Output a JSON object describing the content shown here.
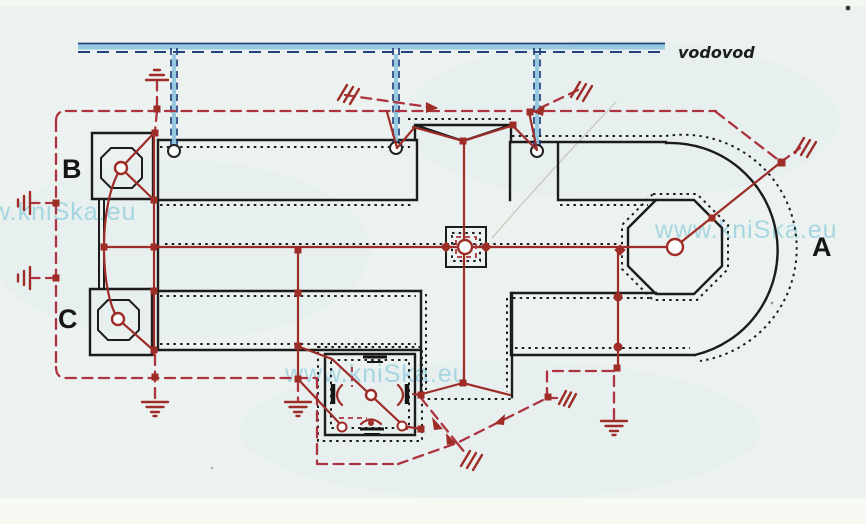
{
  "figure": {
    "description": "Scanned plan of a church building with lightning-protection earthing system, water main and grounding loop"
  },
  "labels": {
    "tower_b": "B",
    "tower_c": "C",
    "apse_a": "A",
    "water_main": "vodovod"
  },
  "watermarks": {
    "left": "w.kniSka.eu",
    "center": "www.kniSka.eu",
    "right": "www.kniSka.eu"
  },
  "colors": {
    "paper": "#ecf2ef",
    "paper_strip": "#f7f9f3",
    "ink_black": "#1c1c1c",
    "conductor_red": "#9e2d28",
    "loop_red": "#ad3340",
    "pipe_navy": "#24427f",
    "pipe_lightblue": "#8fc6dd",
    "watermark_cyan": "#7fc6da"
  }
}
